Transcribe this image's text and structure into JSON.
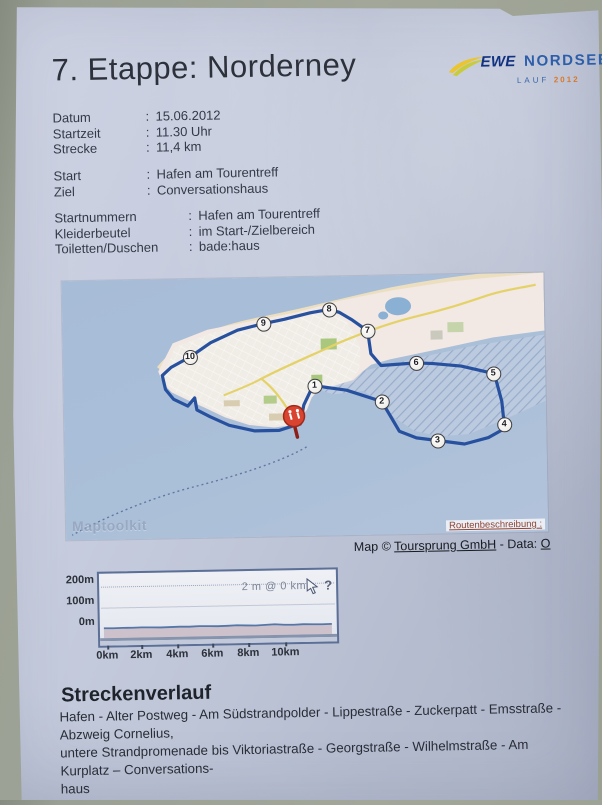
{
  "page": {
    "title": "7. Etappe: Norderney"
  },
  "logo": {
    "brand": "EWE",
    "name": "NORDSEE",
    "lauf": "LAUF",
    "year": "2012"
  },
  "info": {
    "colon": ":",
    "rows_main": [
      {
        "label": "Datum",
        "value": "15.06.2012"
      },
      {
        "label": "Startzeit",
        "value": "11.30 Uhr"
      },
      {
        "label": "Strecke",
        "value": "11,4 km"
      }
    ],
    "rows_startziel": [
      {
        "label": "Start",
        "value": "Hafen am Tourentreff"
      },
      {
        "label": "Ziel",
        "value": "Conversationshaus"
      }
    ],
    "rows_logistics": [
      {
        "label": "Startnummern",
        "value": "Hafen am Tourentreff"
      },
      {
        "label": "Kleiderbeutel",
        "value": "im Start-/Zielbereich"
      },
      {
        "label": "Toiletten/Duschen",
        "value": "bade:haus"
      }
    ]
  },
  "map": {
    "watermark": "Maptoolkit",
    "route_link": "Routenbeschreibung :",
    "attribution": {
      "prefix": "Map © ",
      "link_map": "Toursprung GmbH",
      "sep": " - Data: ",
      "link_data": "O"
    },
    "colors": {
      "route": "#27519f",
      "water": "#a9bdd7",
      "start_marker": "#d94430",
      "waypoint_border": "#3e3e42"
    },
    "waypoints": [
      {
        "label": "1",
        "x": 251,
        "y": 109
      },
      {
        "label": "2",
        "x": 318,
        "y": 126
      },
      {
        "label": "3",
        "x": 373,
        "y": 166
      },
      {
        "label": "4",
        "x": 440,
        "y": 151
      },
      {
        "label": "5",
        "x": 430,
        "y": 100
      },
      {
        "label": "6",
        "x": 353,
        "y": 88
      },
      {
        "label": "7",
        "x": 305,
        "y": 55
      },
      {
        "label": "8",
        "x": 267,
        "y": 33
      },
      {
        "label": "9",
        "x": 201,
        "y": 46
      },
      {
        "label": "10",
        "x": 127,
        "y": 78
      }
    ],
    "route_points": [
      [
        236,
        147
      ],
      [
        240,
        128
      ],
      [
        247,
        114
      ],
      [
        251,
        109
      ],
      [
        283,
        114
      ],
      [
        318,
        126
      ],
      [
        326,
        140
      ],
      [
        335,
        156
      ],
      [
        352,
        163
      ],
      [
        373,
        166
      ],
      [
        400,
        170
      ],
      [
        424,
        164
      ],
      [
        437,
        157
      ],
      [
        440,
        151
      ],
      [
        438,
        128
      ],
      [
        433,
        108
      ],
      [
        430,
        100
      ],
      [
        398,
        92
      ],
      [
        370,
        89
      ],
      [
        353,
        88
      ],
      [
        318,
        90
      ],
      [
        308,
        78
      ],
      [
        306,
        62
      ],
      [
        305,
        55
      ],
      [
        290,
        44
      ],
      [
        277,
        36
      ],
      [
        267,
        33
      ],
      [
        248,
        36
      ],
      [
        222,
        42
      ],
      [
        201,
        46
      ],
      [
        175,
        52
      ],
      [
        148,
        64
      ],
      [
        127,
        78
      ],
      [
        108,
        88
      ],
      [
        99,
        96
      ],
      [
        102,
        110
      ],
      [
        110,
        120
      ],
      [
        124,
        127
      ],
      [
        131,
        119
      ],
      [
        133,
        131
      ],
      [
        146,
        138
      ],
      [
        165,
        147
      ],
      [
        190,
        153
      ],
      [
        215,
        153
      ],
      [
        228,
        149
      ],
      [
        233,
        143
      ]
    ],
    "ferry_path": "M242,170 C215,185 170,198 128,208 C86,218 40,236 6,254"
  },
  "chart_data": {
    "type": "area",
    "title": "",
    "tooltip": "2 m @ 0 km",
    "y_ticks": [
      "200m",
      "100m",
      "0m"
    ],
    "x_ticks": [
      "0km",
      "2km",
      "4km",
      "6km",
      "8km",
      "10km"
    ],
    "x_range_km": [
      0,
      12.4
    ],
    "y_range_m": [
      0,
      250
    ],
    "grid": true,
    "legend": "none",
    "profile_m": [
      2,
      1,
      2,
      2,
      3,
      2,
      1,
      2,
      3,
      2,
      4,
      3,
      2,
      3,
      5,
      3,
      2,
      4,
      6,
      3,
      2,
      4,
      3,
      2,
      3
    ]
  },
  "strecke": {
    "heading": "Streckenverlauf",
    "lines": [
      "Hafen - Alter Postweg - Am Südstrandpolder - Lippestraße - Zuckerpatt - Emsstraße - Abzweig Cornelius,",
      "untere Strandpromenade bis Viktoriastraße - Georgstraße - Wilhelmstraße - Am Kurplatz – Conversations-",
      "haus"
    ]
  }
}
